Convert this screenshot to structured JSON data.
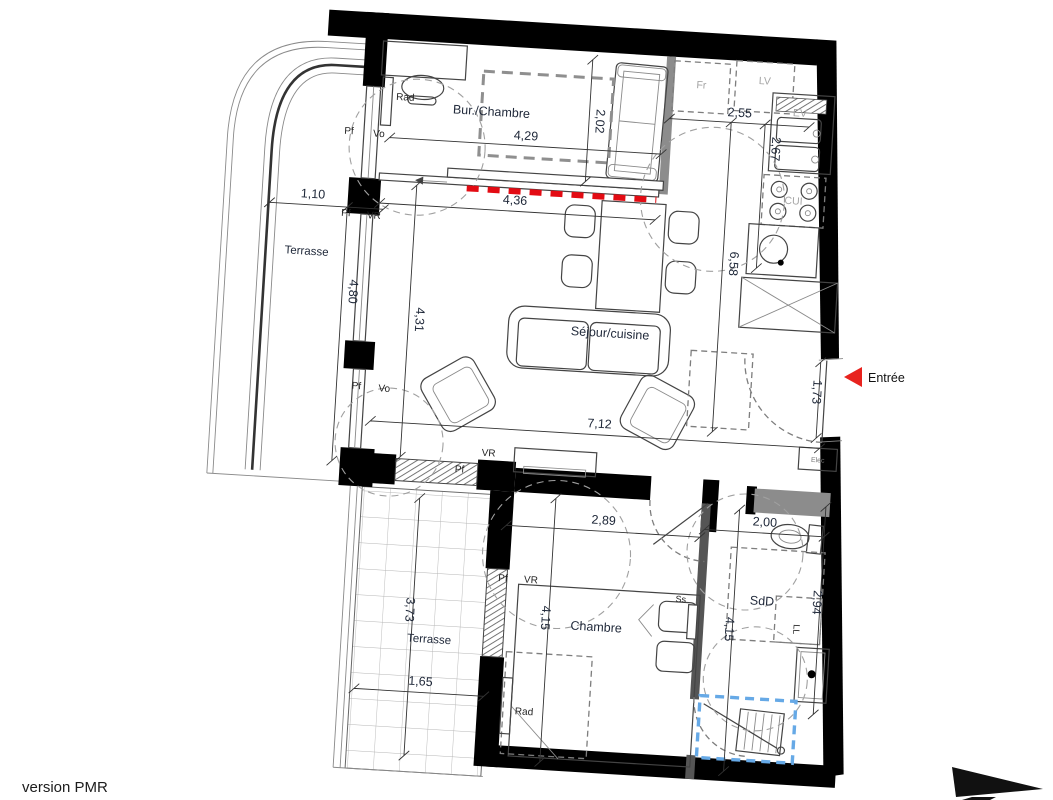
{
  "footer": {
    "version": "version PMR"
  },
  "entry": {
    "label": "Entrée"
  },
  "rooms": {
    "bur_chambre": "Bur./Chambre",
    "terrasse_top": "Terrasse",
    "sejour": "Séjour/cuisine",
    "terrasse_bottom": "Terrasse",
    "chambre": "Chambre",
    "sdd": "SdD"
  },
  "dims": {
    "d429": "4,29",
    "d202": "2,02",
    "d255": "2,55",
    "d267": "2,67",
    "d110": "1,10",
    "d480": "4,80",
    "d436": "4,36",
    "d431": "4,31",
    "d658": "6,58",
    "d173": "1,73",
    "d712": "7,12",
    "d289": "2,89",
    "d200": "2,00",
    "d373": "3,73",
    "d165": "1,65",
    "d415l": "4,15",
    "d415r": "4,15",
    "d294": "2,94"
  },
  "fixtures": {
    "fr": "Fr",
    "lv": "LV",
    "ev": "EV",
    "cui": "CUI",
    "rad_bur": "Rad",
    "rad_chambre": "Rad",
    "pf1": "Pf",
    "vo1": "Vo",
    "pf2": "Pf",
    "vr1": "VR",
    "pf3": "Pf",
    "vo2": "Vo",
    "vr2": "VR",
    "pf4": "Pf",
    "pf5": "Pf",
    "vr3": "VR",
    "ss": "Ss",
    "ll": "LL",
    "elec": "Elec"
  },
  "colors": {
    "wall": "#000000",
    "partition_red": "#e30b13",
    "highlight_blue": "#66a9e6",
    "entry_arrow_red": "#e8231e"
  }
}
